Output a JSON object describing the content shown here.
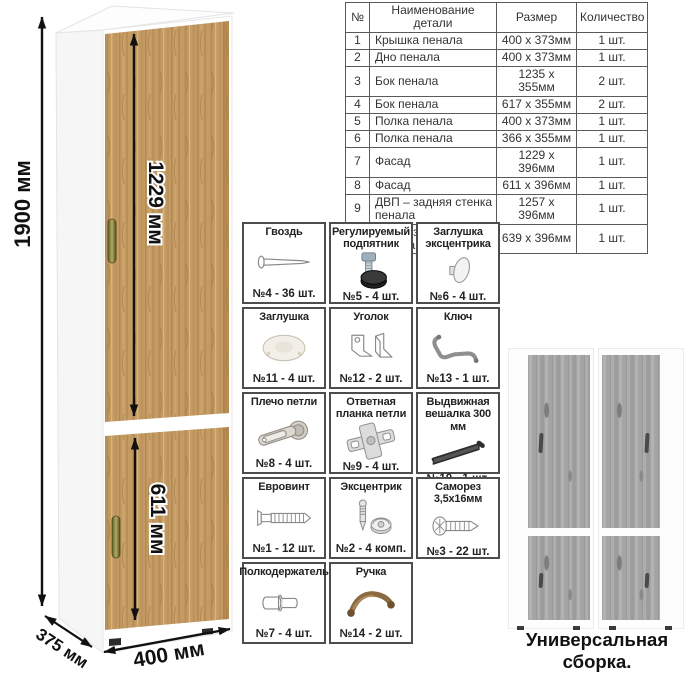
{
  "drawing": {
    "dim_height": "1900 мм",
    "dim_upper_fasad": "1229 мм",
    "dim_lower_fasad": "611 мм",
    "dim_depth": "375 мм",
    "dim_width": "400 мм"
  },
  "parts_table": {
    "headers": [
      "№",
      "Наименование детали",
      "Размер",
      "Количество"
    ],
    "rows": [
      [
        "1",
        "Крышка пенала",
        "400 х 373мм",
        "1 шт."
      ],
      [
        "2",
        "Дно пенала",
        "400 х 373мм",
        "1 шт."
      ],
      [
        "3",
        "Бок пенала",
        "1235 х 355мм",
        "2 шт."
      ],
      [
        "4",
        "Бок пенала",
        "617 х 355мм",
        "2 шт."
      ],
      [
        "5",
        "Полка пенала",
        "400 х 373мм",
        "1 шт."
      ],
      [
        "6",
        "Полка пенала",
        "366 х 355мм",
        "1 шт."
      ],
      [
        "7",
        "Фасад",
        "1229 х 396мм",
        "1 шт."
      ],
      [
        "8",
        "Фасад",
        "611 х 396мм",
        "1 шт."
      ],
      [
        "9",
        "ДВП – задняя стенка пенала",
        "1257 х 396мм",
        "1 шт."
      ],
      [
        "10",
        "ДВП – задняя стенка пенала",
        "639 х 396мм",
        "1 шт."
      ]
    ]
  },
  "hardware_grid": {
    "items": [
      {
        "name": "Гвоздь",
        "count": "№4 - 36 шт.",
        "icon": "nail-icon"
      },
      {
        "name": "Регулируемый подпятник",
        "count": "№5 - 4 шт.",
        "icon": "adjustable-foot-icon"
      },
      {
        "name": "Заглушка эксцентрика",
        "count": "№6 - 4 шт.",
        "icon": "cam-cover-icon"
      },
      {
        "name": "Заглушка",
        "count": "№11 - 4 шт.",
        "icon": "cap-icon"
      },
      {
        "name": "Уголок",
        "count": "№12 - 2 шт.",
        "icon": "corner-bracket-icon"
      },
      {
        "name": "Ключ",
        "count": "№13 - 1 шт.",
        "icon": "hex-key-icon"
      },
      {
        "name": "Плечо петли",
        "count": "№8 - 4 шт.",
        "icon": "hinge-arm-icon"
      },
      {
        "name": "Ответная планка петли",
        "count": "№9 - 4 шт.",
        "icon": "hinge-plate-icon"
      },
      {
        "name": "Выдвижная вешалка 300 мм",
        "count": "№10 - 1 шт.",
        "icon": "pullout-hanger-icon"
      },
      {
        "name": "Евровинт",
        "count": "№1 - 12 шт.",
        "icon": "confirmat-screw-icon"
      },
      {
        "name": "Эксцентрик",
        "count": "№2 - 4 комп.",
        "icon": "cam-lock-icon"
      },
      {
        "name": "Саморез 3,5х16мм",
        "count": "№3 - 22 шт.",
        "icon": "self-tapping-screw-icon"
      },
      {
        "name": "Полкодержатель",
        "count": "№7 - 4 шт.",
        "icon": "shelf-pin-icon"
      },
      {
        "name": "Ручка",
        "count": "№14 - 2 шт.",
        "icon": "handle-icon"
      }
    ]
  },
  "variants": {
    "caption": "Универсальная сборка."
  },
  "colors": {
    "wood_base": "#c49b63",
    "wood_dark": "#a87c46",
    "wood_light": "#d8b57f",
    "gray_door": "#a8a8a8",
    "handle_bronze": "#8f8a45",
    "ink": "#111111",
    "table_border": "#5a5a5a"
  }
}
